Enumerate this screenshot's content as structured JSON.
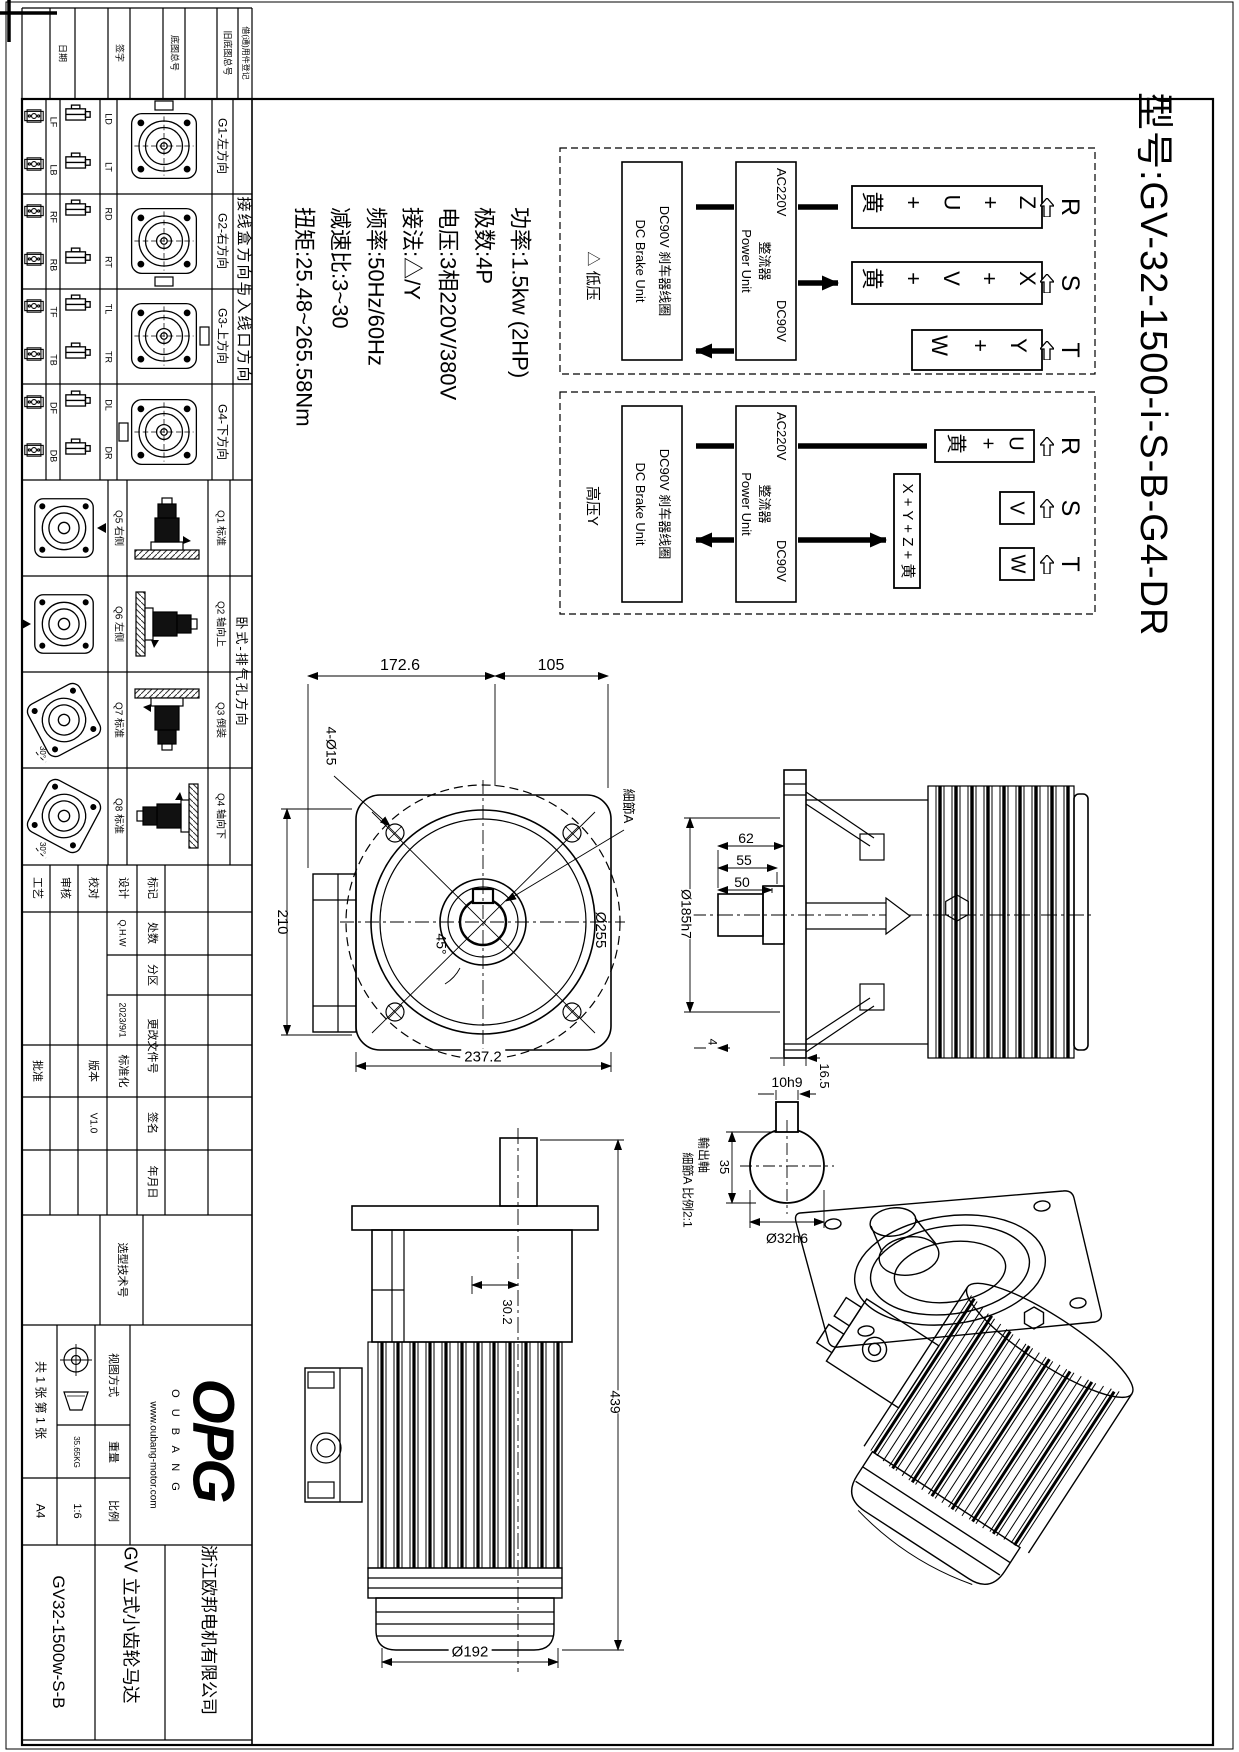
{
  "model_title": "型号:GV-32-1500-i-S-B-G4-DR",
  "specs": {
    "power": "功率:1.5kw (2HP)",
    "poles": "极数:4P",
    "voltage": "电压:3相220V/380V",
    "connection": "接法:△/Y",
    "frequency": "频率:50Hz/60Hz",
    "ratio": "减速比:3~30",
    "torque": "扭矩:25.48~265.58Nm"
  },
  "wiring": {
    "brake_cn": "DC90V 刹车器线圈",
    "brake_en": "DC Brake Unit",
    "rectifier_cn": "整流器",
    "rectifier_en": "Power Unit",
    "ac_in": "AC220V",
    "dc_out": "DC90V",
    "inputs": [
      "R",
      "S",
      "T"
    ],
    "low": {
      "label": "△ 低压",
      "t1": "黄 + U + Z",
      "t2": "黄 + V + X",
      "t3": "W + Y"
    },
    "high": {
      "label": "高压Y",
      "t1": "黄 + U",
      "t2": "V",
      "t3": "W",
      "link": "X + Y + Z + 黄"
    }
  },
  "margin_fields": [
    "日期",
    "签字",
    "底图总号",
    "旧底图总号",
    "借(通)用件登记"
  ],
  "junction_table": {
    "title": "接线盒方向与入线口方向",
    "rows": [
      {
        "a1": "LF",
        "a2": "LB",
        "b1": "LD",
        "b2": "LT",
        "pos": "G1-左方向"
      },
      {
        "a1": "RF",
        "a2": "RB",
        "b1": "RD",
        "b2": "RT",
        "pos": "G2-右方向"
      },
      {
        "a1": "TF",
        "a2": "TB",
        "b1": "TL",
        "b2": "TR",
        "pos": "G3-上方向"
      },
      {
        "a1": "DF",
        "a2": "DB",
        "b1": "DL",
        "b2": "DR",
        "pos": "G4-下方向"
      }
    ]
  },
  "exhaust_table": {
    "title": "卧式-排气孔方向",
    "angle": "30°",
    "rows": [
      {
        "front": "Q5 右侧",
        "side": "Q1 标准"
      },
      {
        "front": "Q6 左侧",
        "side": "Q2 轴向上"
      },
      {
        "front": "Q7 标准",
        "side": "Q3 倒装"
      },
      {
        "front": "Q8 标准",
        "side": "Q4 轴向下"
      }
    ]
  },
  "title_block": {
    "rev": [
      "标记",
      "处数",
      "分区",
      "更改文件号",
      "签名",
      "年月日"
    ],
    "design": "设计",
    "check": "校对",
    "audit": "审核",
    "craft": "工艺",
    "approve": "批准",
    "standardize": "标准化",
    "version_label": "版本",
    "version": "V1.0",
    "designer": "Q.H.W",
    "date": "2023/9/1",
    "selection": "选型技术号",
    "view_label": "视图方式",
    "weight_label": "重量",
    "weight": "35.65KG",
    "scale_label": "比例",
    "scale": "1:6",
    "sheets": "共 1 张 第 1 张",
    "size": "A4",
    "logo": "OPG",
    "logo_letters": "O U B A N G",
    "url": "www.oubang-motor.com",
    "company": "浙江欧邦电机有限公司",
    "product": "GV 立式小齿轮马达",
    "part_no": "GV32-1500w-S-B"
  },
  "dims": {
    "top_w1": "172.6",
    "top_w2": "105",
    "holes": "4-Ø15",
    "left_h": "210",
    "angle": "45°",
    "bottom_w": "237.2",
    "outer_d": "Ø255",
    "detail_ref": "細節A",
    "s1": "62",
    "s2": "55",
    "s3": "50",
    "flange_d": "Ø185h7",
    "t1": "4",
    "t2": "16.5",
    "offset": "30.2",
    "height": "439",
    "body_d": "Ø192",
    "key_w": "10h9",
    "key_h": "35",
    "shaft_d": "Ø32h6",
    "shaft_label": "輸出軸",
    "detail_label": "細節A 比例2:1"
  }
}
